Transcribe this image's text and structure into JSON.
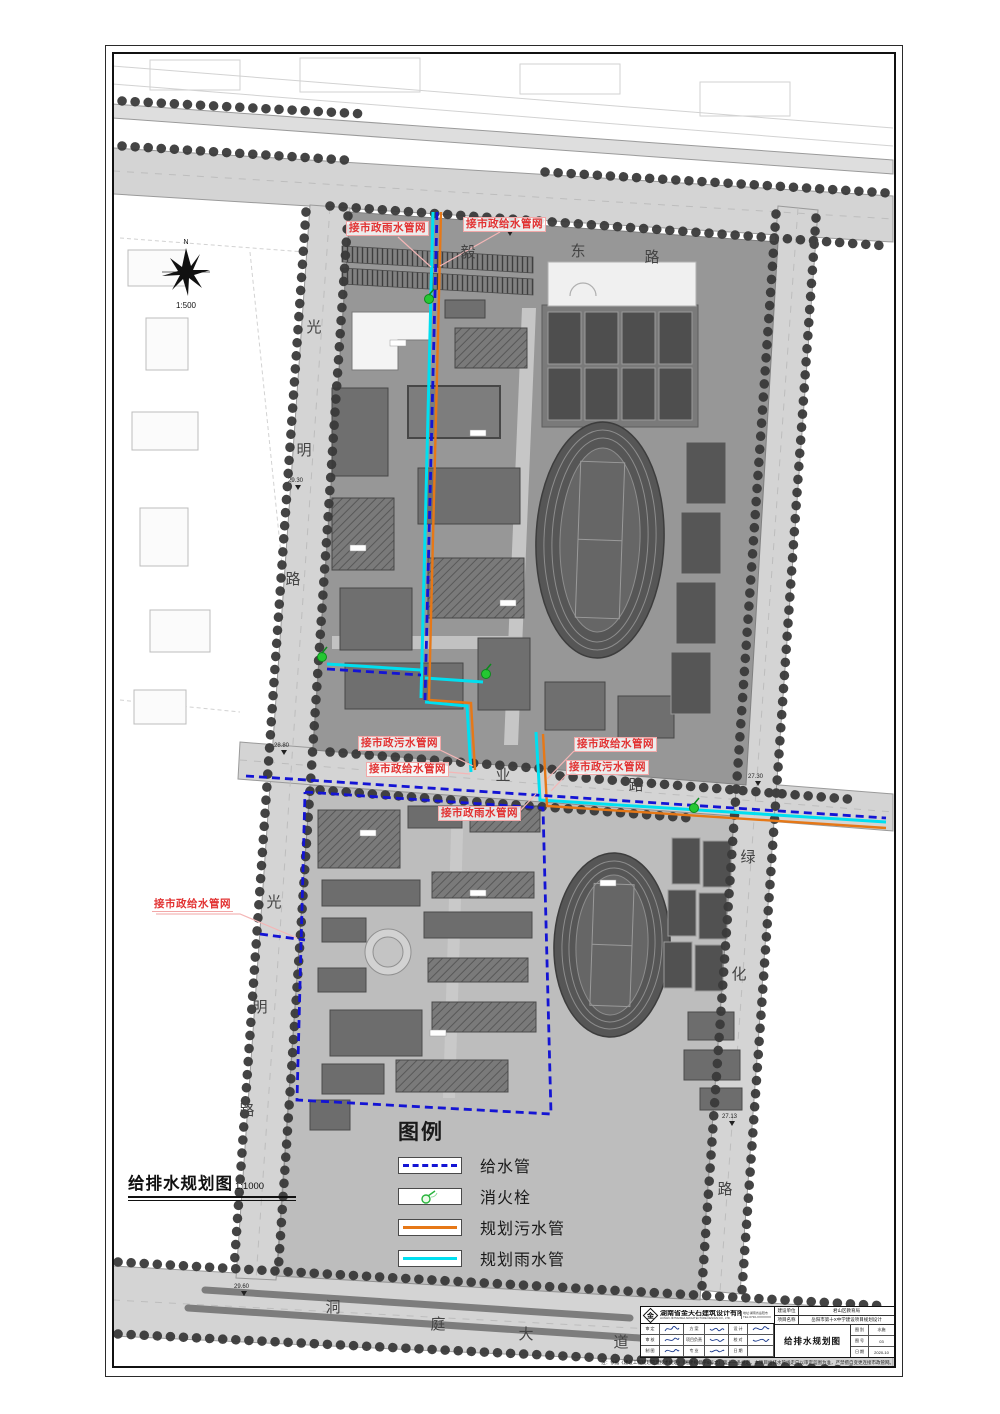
{
  "drawing": {
    "plan_label": "给排水规划图",
    "plan_scale": "1:1000",
    "compass_scale": "1:500",
    "north_label": "N"
  },
  "roads": {
    "top": [
      "毅",
      "东",
      "路"
    ],
    "left_upper": [
      "光",
      "明",
      "路"
    ],
    "left_lower": [
      "光",
      "明",
      "路"
    ],
    "middle": [
      "业",
      "路"
    ],
    "right": [
      "绿",
      "化",
      "路"
    ],
    "bottom": [
      "洞",
      "庭",
      "大",
      "道"
    ]
  },
  "annotations": {
    "rain_top": "接市政雨水管网",
    "water_top": "接市政给水管网",
    "sewage_mid_left": "接市政污水管网",
    "water_mid_left": "接市政给水管网",
    "water_mid_right": "接市政给水管网",
    "sewage_mid_right": "接市政污水管网",
    "rain_lower": "接市政雨水管网",
    "water_left": "接市政给水管网"
  },
  "elevations": [
    "29.85",
    "29.30",
    "28.80",
    "27.30",
    "29.60",
    "27.13"
  ],
  "legend": {
    "title": "图例",
    "items": [
      {
        "label": "给水管"
      },
      {
        "label": "消火栓"
      },
      {
        "label": "规划污水管"
      },
      {
        "label": "规划雨水管"
      }
    ]
  },
  "titleblock": {
    "company_cn": "湖南省金天石建筑设计有限公司",
    "company_en": "HUNAN JINTIANSHI ARCHITECTURE DESIGN CO., LTD.",
    "contact_1": "地址:湖南省岳阳市",
    "contact_2": "TEL:0730-XXXXXXX",
    "logo_glyph": "金",
    "sig_rows": [
      [
        "审 定",
        "方 案",
        "设 计"
      ],
      [
        "审 核",
        "项目负责",
        "校 对"
      ],
      [
        "制 图",
        "专 业",
        "日 期"
      ]
    ],
    "owner_label": "建设单位",
    "owner_value": "君山区教育局",
    "project_label": "项目名称",
    "project_value": "岳阳市第十X中学建设项目规划设计",
    "drawing_title": "给排水规划图",
    "meta": [
      {
        "label": "图 别",
        "value": "水施"
      },
      {
        "label": "图 号",
        "value": "03"
      },
      {
        "label": "日 期",
        "value": "2020-10"
      }
    ],
    "note": "注：依据《建设工程规划管理技术规定》（湘建规督字9号文）第十一条规定，本项目给排水管线走向以审定蓝图为准，严禁擅自变更连接市政管网。"
  },
  "colors": {
    "water_supply": "#1414d4",
    "rain": "#00dff0",
    "sewage": "#e67817",
    "hydrant": "#25c832",
    "annotation_red": "#e23333"
  }
}
